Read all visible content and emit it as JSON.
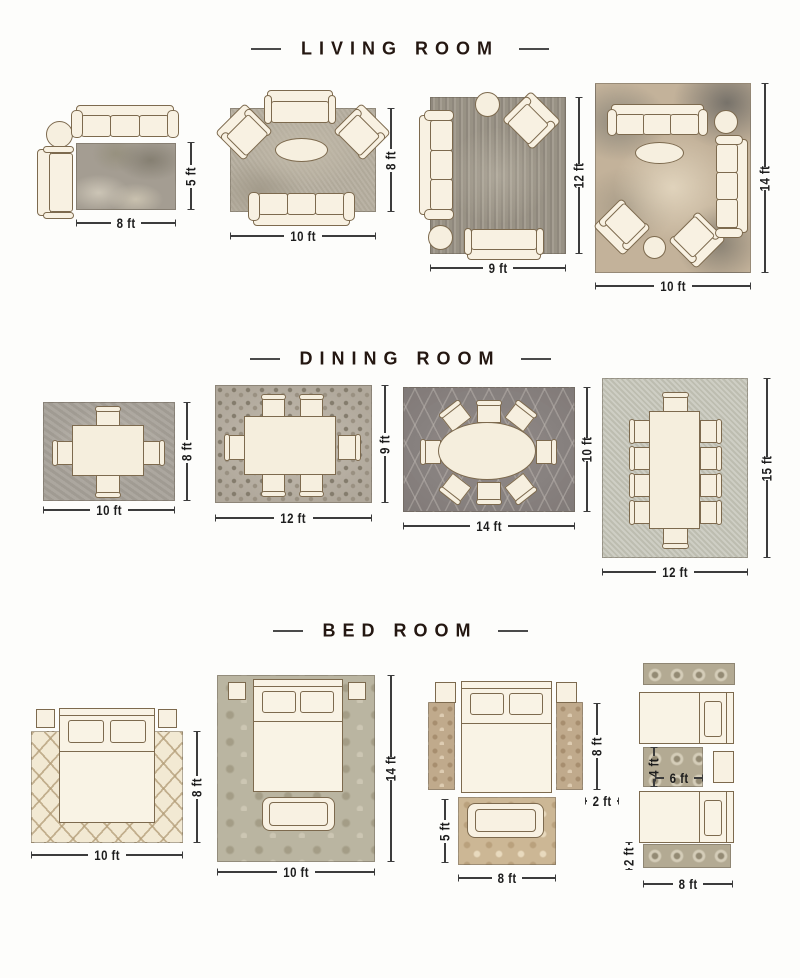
{
  "page": {
    "background_color": "#fdfdfb",
    "title_text_color": "#241711",
    "dimension_text_color": "#1d1d1d",
    "furniture_fill_color": "#f8f1e2",
    "furniture_outline_color": "#7d6a4e"
  },
  "sections": [
    {
      "title": "LIVING ROOM",
      "layouts": [
        {
          "width_label": "8 ft",
          "height_label": "5 ft"
        },
        {
          "width_label": "10 ft",
          "height_label": "8 ft"
        },
        {
          "width_label": "9 ft",
          "height_label": "12 ft"
        },
        {
          "width_label": "10 ft",
          "height_label": "14 ft"
        }
      ]
    },
    {
      "title": "DINING ROOM",
      "layouts": [
        {
          "width_label": "10 ft",
          "height_label": "8 ft"
        },
        {
          "width_label": "12 ft",
          "height_label": "9 ft"
        },
        {
          "width_label": "14 ft",
          "height_label": "10 ft"
        },
        {
          "width_label": "12 ft",
          "height_label": "15 ft"
        }
      ]
    },
    {
      "title": "BED ROOM",
      "layouts": [
        {
          "width_label": "10 ft",
          "height_label": "8 ft"
        },
        {
          "width_label": "10 ft",
          "height_label": "14 ft"
        },
        {
          "side_rug_length_label": "8 ft",
          "side_rug_width_label": "2 ft",
          "foot_rug_height_label": "5 ft",
          "foot_rug_width_label": "8 ft"
        },
        {
          "accent_rug_height_label": "4 ft",
          "accent_rug_width_label": "6 ft",
          "runner_width_label": "2 ft",
          "runner_length_label": "8 ft"
        }
      ]
    }
  ]
}
